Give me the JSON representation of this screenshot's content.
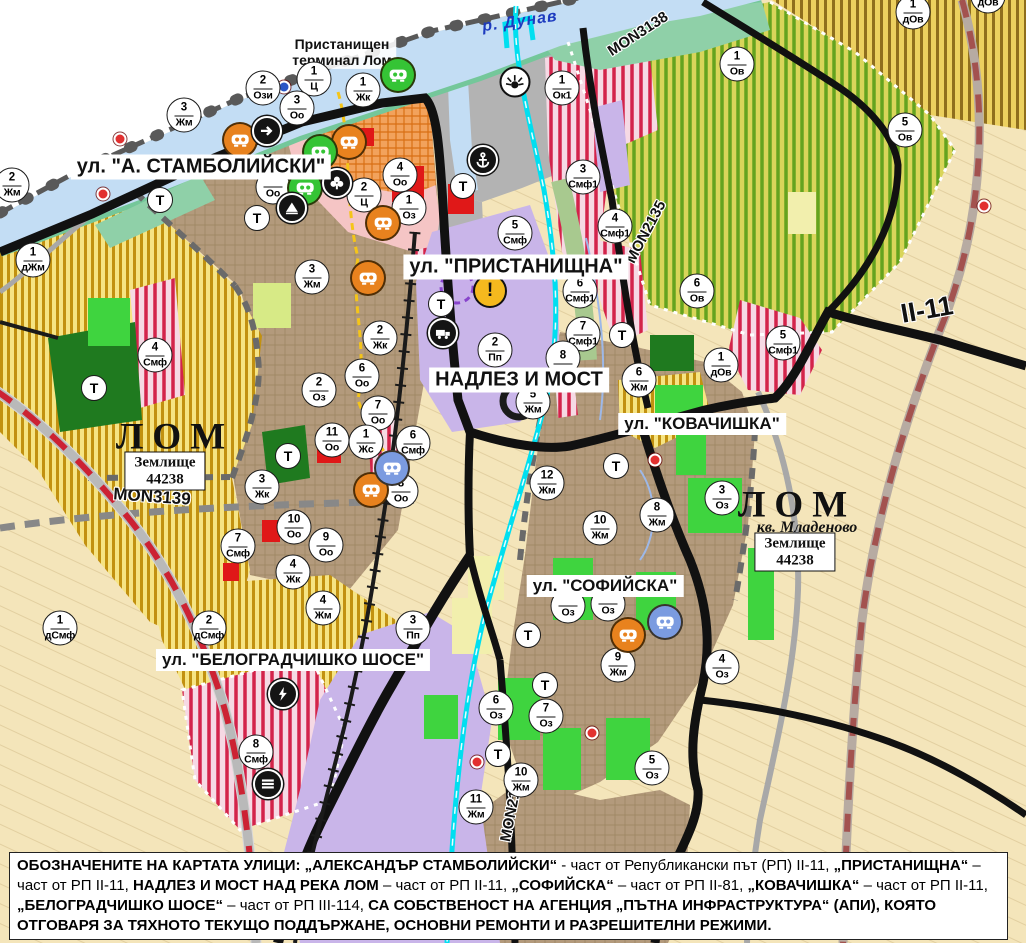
{
  "map": {
    "water_label": {
      "text": "р. Дунав",
      "x": 520,
      "y": 22,
      "rotate": -8
    },
    "port_label": {
      "line1": "Пристанищен",
      "line2": "терминал Лом",
      "x": 342,
      "y": 52
    },
    "street_labels": [
      {
        "text": "ул. \"А. СТАМБОЛИЙСКИ\"",
        "x": 201,
        "y": 167,
        "size": 20
      },
      {
        "text": "ул. \"ПРИСТАНИЩНА\"",
        "x": 516,
        "y": 267,
        "size": 20
      },
      {
        "text": "НАДЛЕЗ И МОСТ",
        "x": 519,
        "y": 380,
        "size": 20
      },
      {
        "text": "ул. \"КОВАЧИШКА\"",
        "x": 702,
        "y": 424,
        "size": 17
      },
      {
        "text": "ул. \"СОФИЙСКА\"",
        "x": 605,
        "y": 586,
        "size": 17
      },
      {
        "text": "ул. \"БЕЛОГРАДЧИШКО ШОСЕ\"",
        "x": 293,
        "y": 660,
        "size": 17
      }
    ],
    "city_labels": [
      {
        "text": "ЛОМ",
        "x": 175,
        "y": 437
      },
      {
        "text": "ЛОМ",
        "x": 797,
        "y": 505
      }
    ],
    "quarter_label": {
      "text": "кв. Младеново",
      "x": 807,
      "y": 528
    },
    "boxed_labels": [
      {
        "line1": "Землище",
        "line2": "44238",
        "x": 165,
        "y": 471
      },
      {
        "line1": "Землище",
        "line2": "44238",
        "x": 795,
        "y": 552
      }
    ],
    "road_labels": [
      {
        "text": "MON3138",
        "x": 638,
        "y": 34,
        "rotate": -33,
        "size": 15
      },
      {
        "text": "MON2135",
        "x": 646,
        "y": 232,
        "rotate": -62,
        "size": 15
      },
      {
        "text": "MON3139",
        "x": 152,
        "y": 497,
        "rotate": 4,
        "size": 17
      },
      {
        "text": "MON2136",
        "x": 512,
        "y": 808,
        "rotate": -79,
        "size": 15
      },
      {
        "text": "II-11",
        "x": 927,
        "y": 310,
        "rotate": -10,
        "size": 27
      }
    ],
    "zone_markers": [
      {
        "x": 263,
        "y": 88,
        "num": "2",
        "code": "Ози"
      },
      {
        "x": 314,
        "y": 79,
        "num": "1",
        "code": "Ц"
      },
      {
        "x": 363,
        "y": 90,
        "num": "1",
        "code": "Жк"
      },
      {
        "x": 297,
        "y": 108,
        "num": "3",
        "code": "Оо"
      },
      {
        "x": 562,
        "y": 88,
        "num": "1",
        "code": "Ок1"
      },
      {
        "x": 737,
        "y": 64,
        "num": "1",
        "code": "Ов"
      },
      {
        "x": 913,
        "y": 12,
        "num": "1",
        "code": "дОв"
      },
      {
        "x": 988,
        "y": -4,
        "num": "",
        "code": "дОв"
      },
      {
        "x": 905,
        "y": 130,
        "num": "5",
        "code": "Ов"
      },
      {
        "x": 12,
        "y": 185,
        "num": "2",
        "code": "Жм"
      },
      {
        "x": 184,
        "y": 115,
        "num": "3",
        "code": "Жм"
      },
      {
        "x": 33,
        "y": 260,
        "num": "1",
        "code": "дЖм"
      },
      {
        "x": 312,
        "y": 277,
        "num": "3",
        "code": "Жм"
      },
      {
        "x": 273,
        "y": 187,
        "num": "",
        "code": "Оо"
      },
      {
        "x": 400,
        "y": 175,
        "num": "4",
        "code": "Оо"
      },
      {
        "x": 364,
        "y": 195,
        "num": "2",
        "code": "Ц"
      },
      {
        "x": 409,
        "y": 208,
        "num": "1",
        "code": "Оз"
      },
      {
        "x": 583,
        "y": 177,
        "num": "3",
        "code": "Смф1"
      },
      {
        "x": 615,
        "y": 226,
        "num": "4",
        "code": "Смф1"
      },
      {
        "x": 515,
        "y": 233,
        "num": "5",
        "code": "Смф"
      },
      {
        "x": 580,
        "y": 291,
        "num": "6",
        "code": "Смф1"
      },
      {
        "x": 583,
        "y": 334,
        "num": "7",
        "code": "Смф1"
      },
      {
        "x": 495,
        "y": 350,
        "num": "2",
        "code": "Пп"
      },
      {
        "x": 380,
        "y": 338,
        "num": "2",
        "code": "Жк"
      },
      {
        "x": 362,
        "y": 376,
        "num": "6",
        "code": "Оо"
      },
      {
        "x": 319,
        "y": 390,
        "num": "2",
        "code": "Оз"
      },
      {
        "x": 378,
        "y": 413,
        "num": "7",
        "code": "Оо"
      },
      {
        "x": 332,
        "y": 440,
        "num": "11",
        "code": "Оо"
      },
      {
        "x": 366,
        "y": 442,
        "num": "1",
        "code": "Жс"
      },
      {
        "x": 413,
        "y": 443,
        "num": "6",
        "code": "Смф"
      },
      {
        "x": 401,
        "y": 491,
        "num": "8",
        "code": "Оо"
      },
      {
        "x": 294,
        "y": 527,
        "num": "10",
        "code": "Оо"
      },
      {
        "x": 326,
        "y": 545,
        "num": "9",
        "code": "Оо"
      },
      {
        "x": 262,
        "y": 487,
        "num": "3",
        "code": "Жк"
      },
      {
        "x": 238,
        "y": 546,
        "num": "7",
        "code": "Смф"
      },
      {
        "x": 293,
        "y": 572,
        "num": "4",
        "code": "Жк"
      },
      {
        "x": 155,
        "y": 355,
        "num": "4",
        "code": "Смф"
      },
      {
        "x": 563,
        "y": 358,
        "num": "8",
        "code": ""
      },
      {
        "x": 533,
        "y": 402,
        "num": "5",
        "code": "Жм"
      },
      {
        "x": 639,
        "y": 380,
        "num": "6",
        "code": "Жм"
      },
      {
        "x": 697,
        "y": 291,
        "num": "6",
        "code": "Ов"
      },
      {
        "x": 721,
        "y": 365,
        "num": "1",
        "code": "дОв"
      },
      {
        "x": 783,
        "y": 343,
        "num": "5",
        "code": "Смф1"
      },
      {
        "x": 547,
        "y": 483,
        "num": "12",
        "code": "Жм"
      },
      {
        "x": 600,
        "y": 528,
        "num": "10",
        "code": "Жм"
      },
      {
        "x": 657,
        "y": 515,
        "num": "8",
        "code": "Жм"
      },
      {
        "x": 722,
        "y": 498,
        "num": "3",
        "code": "Оз"
      },
      {
        "x": 618,
        "y": 665,
        "num": "9",
        "code": "Жм"
      },
      {
        "x": 722,
        "y": 667,
        "num": "4",
        "code": "Оз"
      },
      {
        "x": 568,
        "y": 606,
        "num": "",
        "code": "Оз"
      },
      {
        "x": 608,
        "y": 604,
        "num": "",
        "code": "Оз"
      },
      {
        "x": 496,
        "y": 708,
        "num": "6",
        "code": "Оз"
      },
      {
        "x": 546,
        "y": 716,
        "num": "7",
        "code": "Оз"
      },
      {
        "x": 521,
        "y": 780,
        "num": "10",
        "code": "Жм"
      },
      {
        "x": 476,
        "y": 807,
        "num": "11",
        "code": "Жм"
      },
      {
        "x": 652,
        "y": 768,
        "num": "5",
        "code": "Оз"
      },
      {
        "x": 209,
        "y": 628,
        "num": "2",
        "code": "дСмф"
      },
      {
        "x": 323,
        "y": 608,
        "num": "4",
        "code": "Жм"
      },
      {
        "x": 413,
        "y": 628,
        "num": "3",
        "code": "Пп"
      },
      {
        "x": 256,
        "y": 752,
        "num": "8",
        "code": "Смф"
      },
      {
        "x": 60,
        "y": 628,
        "num": "1",
        "code": "дСмф"
      }
    ],
    "t_markers": [
      {
        "x": 160,
        "y": 200
      },
      {
        "x": 257,
        "y": 218
      },
      {
        "x": 441,
        "y": 304
      },
      {
        "x": 463,
        "y": 186
      },
      {
        "x": 288,
        "y": 456
      },
      {
        "x": 622,
        "y": 335
      },
      {
        "x": 616,
        "y": 466
      },
      {
        "x": 528,
        "y": 635
      },
      {
        "x": 545,
        "y": 685
      },
      {
        "x": 498,
        "y": 754
      },
      {
        "x": 94,
        "y": 388
      }
    ],
    "icon_markers": [
      {
        "x": 240,
        "y": 140,
        "type": "mask",
        "bg": "#e8821e"
      },
      {
        "x": 349,
        "y": 142,
        "type": "mask",
        "bg": "#e8821e"
      },
      {
        "x": 383,
        "y": 223,
        "type": "mask",
        "bg": "#e8821e"
      },
      {
        "x": 368,
        "y": 278,
        "type": "mask",
        "bg": "#e8821e"
      },
      {
        "x": 371,
        "y": 490,
        "type": "mask",
        "bg": "#e8821e"
      },
      {
        "x": 628,
        "y": 635,
        "type": "mask",
        "bg": "#e8821e"
      },
      {
        "x": 398,
        "y": 75,
        "type": "mask",
        "bg": "#35c435"
      },
      {
        "x": 320,
        "y": 152,
        "type": "mask",
        "bg": "#35c435"
      },
      {
        "x": 305,
        "y": 188,
        "type": "mask",
        "bg": "#35c435"
      },
      {
        "x": 392,
        "y": 468,
        "type": "mask",
        "bg": "#7b9be0"
      },
      {
        "x": 665,
        "y": 622,
        "type": "mask",
        "bg": "#7b9be0"
      },
      {
        "x": 267,
        "y": 131,
        "type": "arrow",
        "bg": "#141414"
      },
      {
        "x": 337,
        "y": 183,
        "type": "club",
        "bg": "#141414"
      },
      {
        "x": 292,
        "y": 208,
        "type": "mound",
        "bg": "#141414"
      },
      {
        "x": 483,
        "y": 160,
        "type": "anchor",
        "bg": "#141414"
      },
      {
        "x": 443,
        "y": 333,
        "type": "truck",
        "bg": "#141414"
      },
      {
        "x": 283,
        "y": 694,
        "type": "lightning",
        "bg": "#141414"
      },
      {
        "x": 268,
        "y": 784,
        "type": "railway",
        "bg": "#141414"
      },
      {
        "x": 515,
        "y": 82,
        "type": "sun",
        "bg": "#ffffff"
      },
      {
        "x": 490,
        "y": 291,
        "type": "warning",
        "bg": "#f5b91e"
      }
    ],
    "dots": [
      {
        "x": 120,
        "y": 139,
        "color": "#e23030"
      },
      {
        "x": 103,
        "y": 194,
        "color": "#e23030"
      },
      {
        "x": 655,
        "y": 460,
        "color": "#e23030"
      },
      {
        "x": 477,
        "y": 762,
        "color": "#e23030"
      },
      {
        "x": 984,
        "y": 206,
        "color": "#e23030"
      },
      {
        "x": 592,
        "y": 733,
        "color": "#e23030"
      },
      {
        "x": 284,
        "y": 87,
        "color": "#2a56c6"
      }
    ],
    "zone_colors": {
      "residential_Жм": "#b39a7c",
      "vineyards": "#f6e483",
      "orchards_Ов": "#d9d55a",
      "mixed_Смф_stripe": "#d3234a",
      "center_Ц": "#f5c5c5",
      "production_Пп": "#c9b5e9",
      "port_territory": "#b3b3b3",
      "fields": "#f4e5ba",
      "parks_Оз": "#3fd43f",
      "forest": "#1f7a1f",
      "river": "#c3ddf4",
      "channel": "#00dff0",
      "main_road": "#111111"
    }
  },
  "caption": {
    "segments": [
      {
        "text": "ОБОЗНАЧЕНИТЕ НА КАРТАТА УЛИЦИ: „АЛЕКСАНДЪР СТАМБОЛИЙСКИ“",
        "bold": true
      },
      {
        "text": " - част от Републикански път (РП) II-11, ",
        "bold": false
      },
      {
        "text": "„ПРИСТАНИЩНА“",
        "bold": true
      },
      {
        "text": " – част от РП II-11, ",
        "bold": false
      },
      {
        "text": "НАДЛЕЗ И МОСТ НАД РЕКА ЛОМ",
        "bold": true
      },
      {
        "text": " – част от РП II-11, ",
        "bold": false
      },
      {
        "text": "„СОФИЙСКА“",
        "bold": true
      },
      {
        "text": " – част от РП II-81, ",
        "bold": false
      },
      {
        "text": "„КОВАЧИШКА“",
        "bold": true
      },
      {
        "text": " – част от РП II-11, ",
        "bold": false
      },
      {
        "text": "„БЕЛОГРАДЧИШКО ШОСЕ“",
        "bold": true
      },
      {
        "text": " – част от РП III-114, ",
        "bold": false
      },
      {
        "text": "СА СОБСТВЕНОСТ НА АГЕНЦИЯ „ПЪТНА ИНФРАСТРУКТУРА“ (АПИ), КОЯТО ОТГОВАРЯ ЗА ТЯХНОТО ТЕКУЩО ПОДДЪРЖАНЕ, ОСНОВНИ РЕМОНТИ И РАЗРЕШИТЕЛНИ РЕЖИМИ.",
        "bold": true
      }
    ]
  }
}
